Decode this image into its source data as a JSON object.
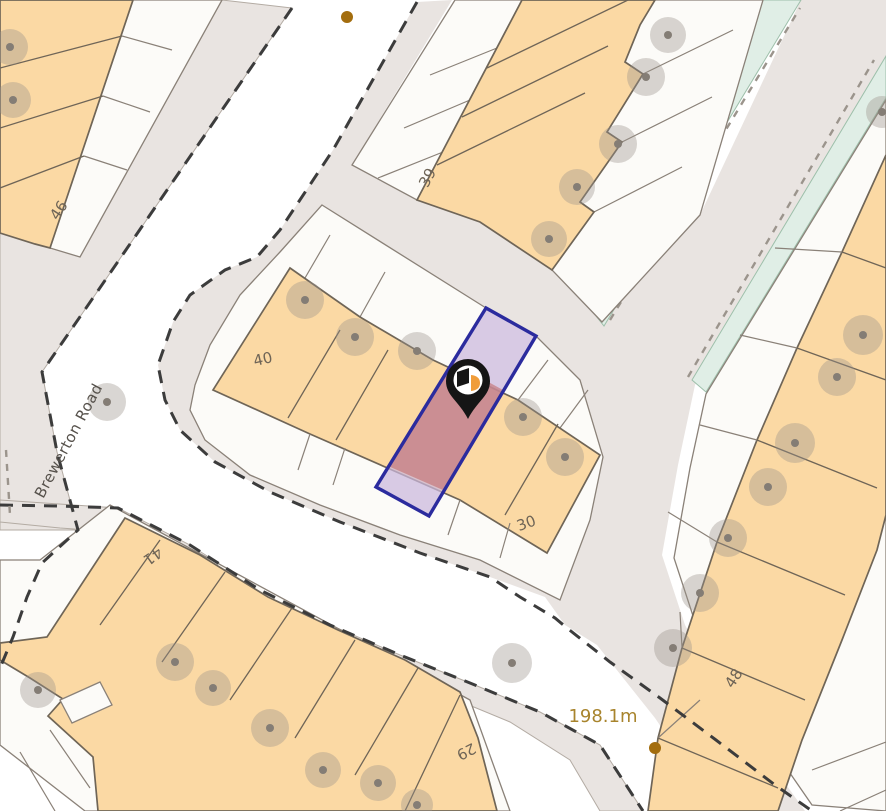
{
  "map": {
    "type": "property-location-map",
    "street_name": "Brewerton Road",
    "measurement_label": "198.1m",
    "house_numbers": {
      "n46": "46",
      "n39": "39",
      "n40": "40",
      "n30": "30",
      "n41": "41",
      "n29": "29",
      "n48": "48"
    },
    "selected_property": {
      "number_row": "30",
      "highlighted": true
    },
    "marker": {
      "icon": "property-marker-pin",
      "x": 468,
      "y": 418
    },
    "survey_dots": [
      {
        "x": 347,
        "y": 17
      },
      {
        "x": 655,
        "y": 748
      }
    ],
    "colors": {
      "road": "#e9e4e1",
      "plot": "#fcfbf8",
      "building": "#fbd9a4",
      "verge": "#e0eee6",
      "boundary_dash": "#3c3c3c",
      "selection_outline": "#2b2b9e",
      "selection_fill": "#cbb7dd",
      "building_highlight": "#c47070",
      "marker_black": "#151515",
      "marker_accent": "#f09d3a",
      "label": "#6e6456",
      "street_label": "#56514b",
      "measure_label": "#a8842d",
      "tree": "#9b948c",
      "dot": "#a36d0e"
    }
  }
}
